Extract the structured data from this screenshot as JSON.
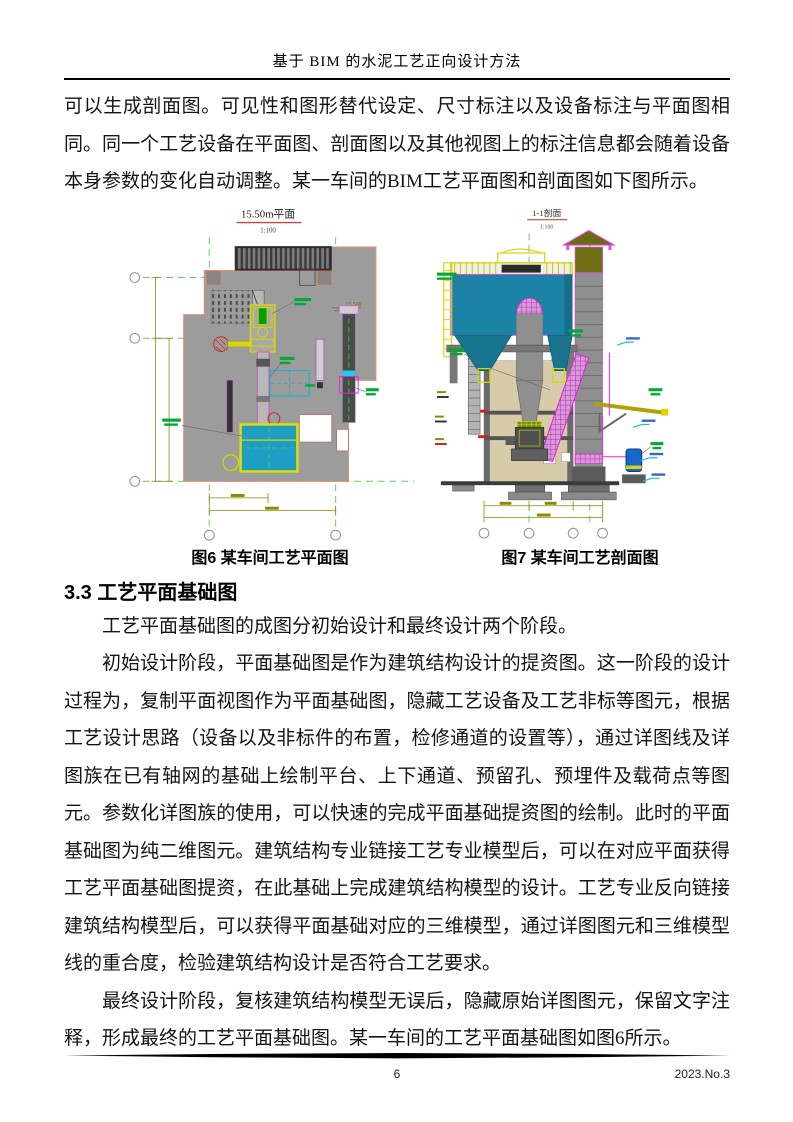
{
  "header": {
    "title": "基于 BIM 的水泥工艺正向设计方法"
  },
  "content": {
    "para1": "可以生成剖面图。可见性和图形替代设定、尺寸标注以及设备标注与平面图相同。同一个工艺设备在平面图、剖面图以及其他视图上的标注信息都会随着设备本身参数的变化自动调整。某一车间的BIM工艺平面图和剖面图如下图所示。",
    "section_heading": "3.3 工艺平面基础图",
    "para2": "工艺平面基础图的成图分初始设计和最终设计两个阶段。",
    "para3": "初始设计阶段，平面基础图是作为建筑结构设计的提资图。这一阶段的设计过程为，复制平面视图作为平面基础图，隐藏工艺设备及工艺非标等图元，根据工艺设计思路（设备以及非标件的布置，检修通道的设置等），通过详图线及详图族在已有轴网的基础上绘制平台、上下通道、预留孔、预埋件及载荷点等图元。参数化详图族的使用，可以快速的完成平面基础提资图的绘制。此时的平面基础图为纯二维图元。建筑结构专业链接工艺专业模型后，可以在对应平面获得工艺平面基础图提资，在此基础上完成建筑结构模型的设计。工艺专业反向链接建筑结构模型后，可以获得平面基础对应的三维模型，通过详图图元和三维模型线的重合度，检验建筑结构设计是否符合工艺要求。",
    "para4": "最终设计阶段，复核建筑结构模型无误后，隐藏原始详图图元，保留文字注释，形成最终的工艺平面基础图。某一车间的工艺平面基础图如图6所示。"
  },
  "figures": {
    "fig6": {
      "drawing_title": "15.50m平面",
      "scale": "1:100",
      "elevation_mark": "15.500",
      "caption": "图6 某车间工艺平面图"
    },
    "fig7": {
      "drawing_title": "1-1剖面",
      "scale": "1:100",
      "caption": "图7 某车间工艺剖面图"
    }
  },
  "footer": {
    "page_number": "6",
    "issue": "2023.No.3"
  },
  "colors": {
    "equipment_teal": "#1b84a6",
    "equipment_cyan": "#1f9ec4",
    "highlight_yellow": "#e0e000",
    "annotation_green": "#00aa33",
    "grid_green": "#55cc55",
    "magenta": "#dd22dd",
    "dim_olive": "#8a8a00",
    "building_gray": "#9c9c9c",
    "wall_tan": "#d8cba9",
    "vessel_blue": "#1866cc"
  }
}
